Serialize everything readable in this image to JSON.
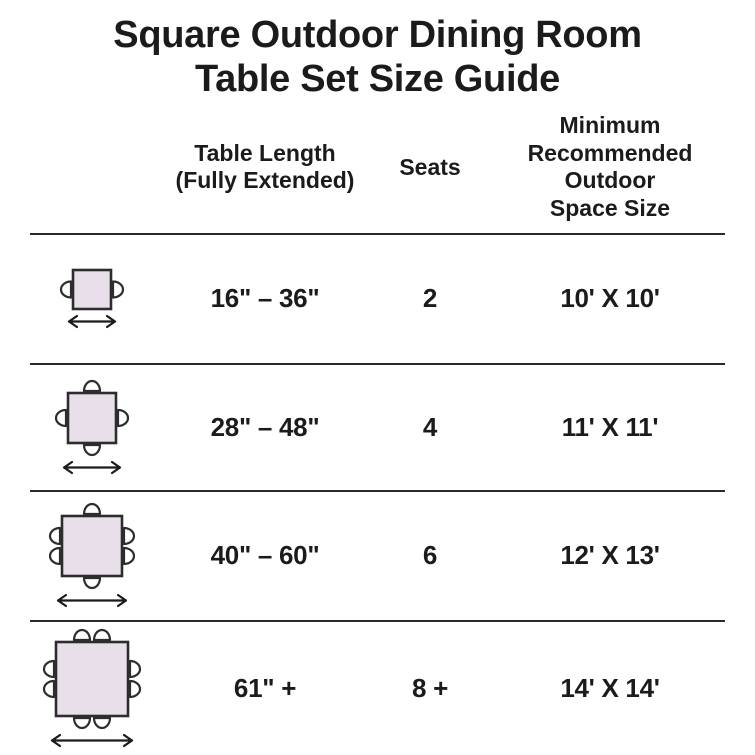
{
  "title": "Square Outdoor Dining Room\nTable Set Size Guide",
  "headers": {
    "length": "Table Length\n(Fully Extended)",
    "seats": "Seats",
    "space": "Minimum\nRecommended\nOutdoor\nSpace Size"
  },
  "rows": [
    {
      "length": "16\" – 36\"",
      "seats": "2",
      "space": "10' X 10'",
      "icon": {
        "name": "table-2-seat-diagram-icon",
        "table_w": 38,
        "table_h": 39,
        "chairs": {
          "left": 1,
          "right": 1,
          "top": 0,
          "bottom": 0
        }
      }
    },
    {
      "length": "28\" – 48\"",
      "seats": "4",
      "space": "11' X 11'",
      "icon": {
        "name": "table-4-seat-diagram-icon",
        "table_w": 48,
        "table_h": 50,
        "chairs": {
          "left": 1,
          "right": 1,
          "top": 1,
          "bottom": 1
        }
      }
    },
    {
      "length": "40\" – 60\"",
      "seats": "6",
      "space": "12' X 13'",
      "icon": {
        "name": "table-6-seat-diagram-icon",
        "table_w": 60,
        "table_h": 60,
        "chairs": {
          "left": 2,
          "right": 2,
          "top": 1,
          "bottom": 1
        }
      }
    },
    {
      "length": "61\" +",
      "seats": "8 +",
      "space": "14' X 14'",
      "icon": {
        "name": "table-8-seat-diagram-icon",
        "table_w": 72,
        "table_h": 74,
        "chairs": {
          "left": 2,
          "right": 2,
          "top": 2,
          "bottom": 2
        }
      }
    }
  ],
  "colors": {
    "background": "#ffffff",
    "text": "#1b1b1b",
    "divider": "#2b2a2b",
    "outline": "#2e2d2e",
    "table_fill": "#E9DFEA",
    "chair_fill": "#ffffff"
  }
}
